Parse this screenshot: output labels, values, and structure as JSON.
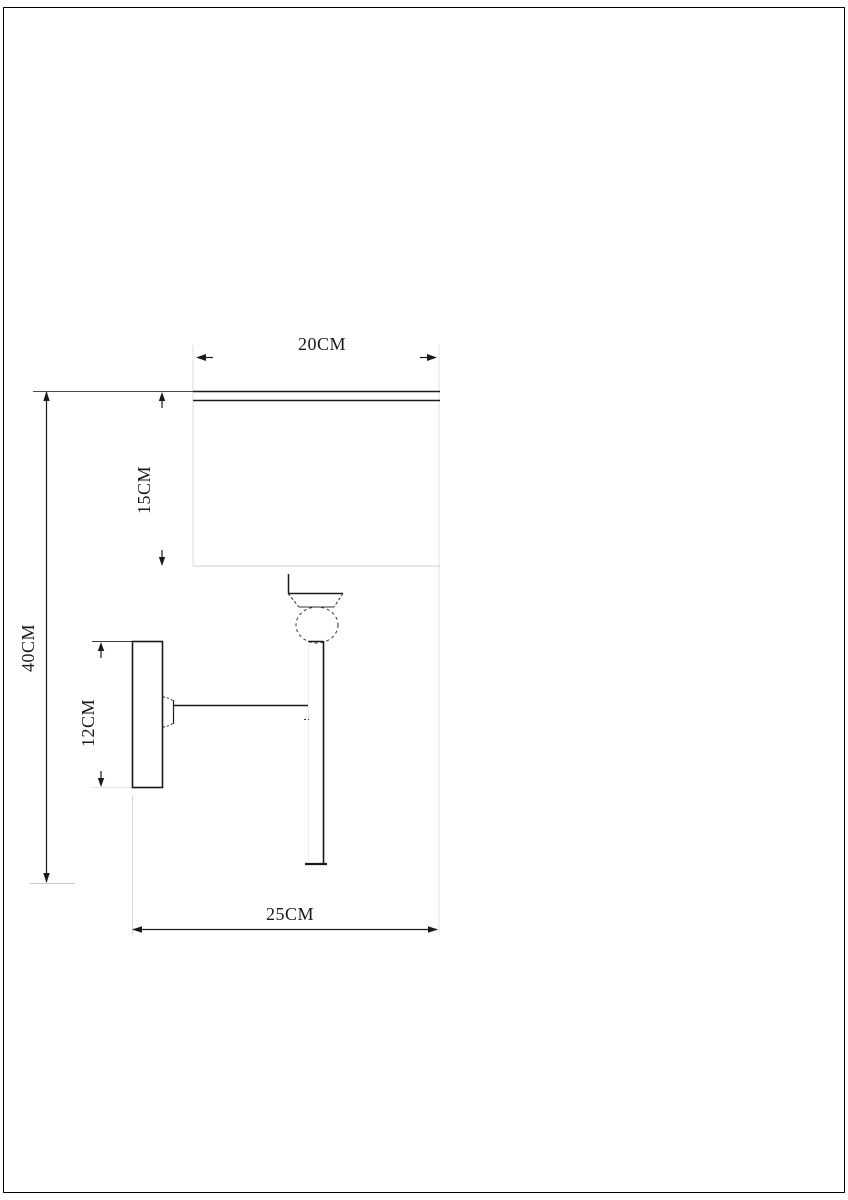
{
  "page": {
    "background_color": "#ffffff",
    "border_color": "#000000"
  },
  "drawing": {
    "type": "technical-dimension-diagram",
    "subject": "wall lamp side-view line drawing",
    "line_color": "#1a1a1a",
    "faint_line_color": "#d9d9d9",
    "dimensions": {
      "shade_width": {
        "label": "20CM"
      },
      "shade_height": {
        "label": "15CM"
      },
      "overall_height": {
        "label": "40CM"
      },
      "backplate_height": {
        "label": "12CM"
      },
      "overall_depth": {
        "label": "25CM"
      }
    }
  }
}
